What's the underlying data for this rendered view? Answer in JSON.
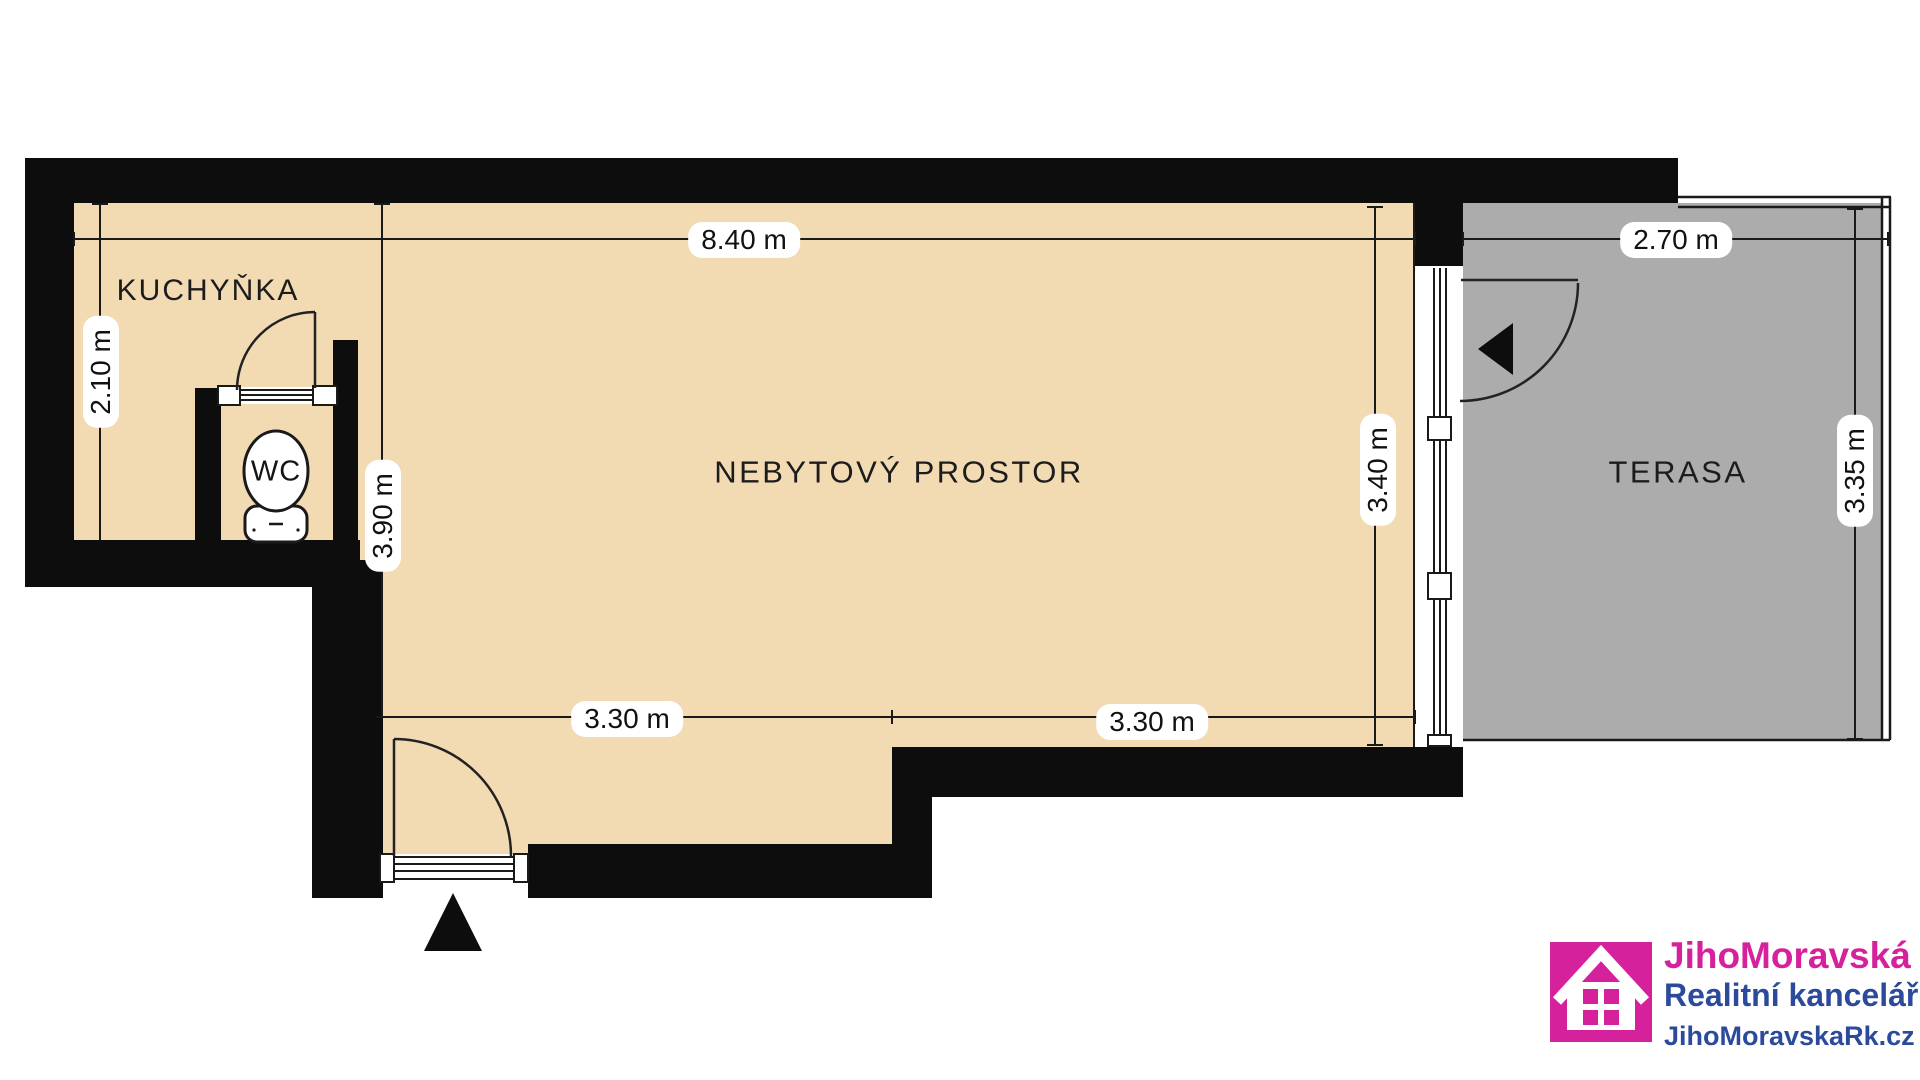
{
  "floorplan": {
    "rooms": {
      "kitchen_label": "KUCHYŇKA",
      "wc_label": "WC",
      "main_label": "NEBYTOVÝ PROSTOR",
      "terrace_label": "TERASA"
    },
    "dimensions": {
      "top_width": "8.40 m",
      "terrace_width": "2.70 m",
      "kitchen_depth": "2.10 m",
      "left_depth": "3.90 m",
      "main_depth": "3.40 m",
      "terrace_depth": "3.35 m",
      "bottom_left_width": "3.30 m",
      "bottom_right_width": "3.30 m"
    },
    "colors": {
      "floor": "#F2DAB3",
      "terrace": "#ACACAC",
      "walls": "#0D0D0D",
      "lines": "#1A1A1A",
      "dimension_pill": "#FFFFFF"
    }
  },
  "logo": {
    "brand": "JihoMoravská",
    "subtitle": "Realitní kancelář",
    "website": "JihoMoravskaRk.cz",
    "brand_color": "#D6219C",
    "text_color": "#2B4A9B"
  }
}
